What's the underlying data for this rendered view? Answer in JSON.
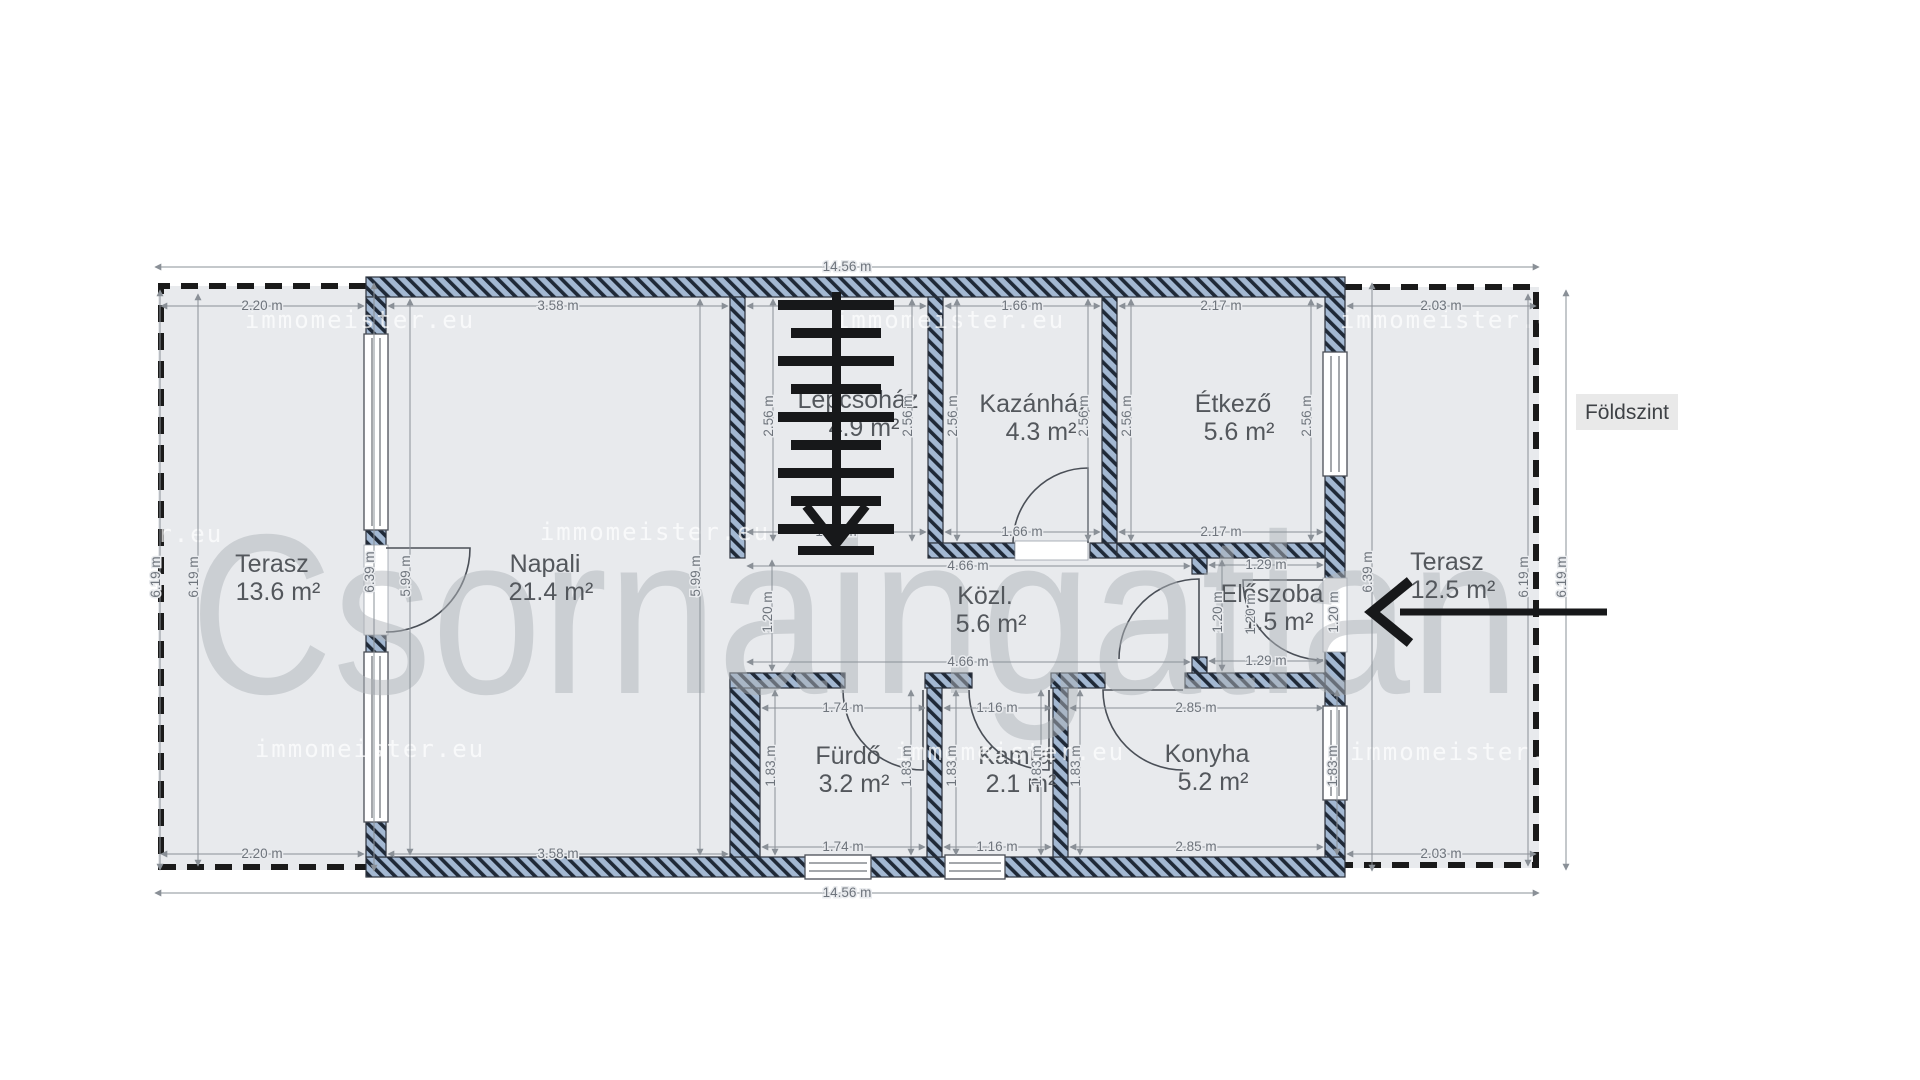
{
  "floor_label": "Földszint",
  "watermarks": {
    "brand": "Csornaingatlan",
    "site": "immomeister.eu",
    "site_positions": [
      [
        360,
        328
      ],
      [
        950,
        328
      ],
      [
        1455,
        328
      ],
      [
        108,
        542
      ],
      [
        655,
        540
      ],
      [
        370,
        757
      ],
      [
        1010,
        760
      ],
      [
        1465,
        760
      ]
    ]
  },
  "colors": {
    "wall_fill": "#a3b8d2",
    "wall_stripe": "#1f2937",
    "room_fill": "#e8eaed",
    "dim_text": "#6e747c",
    "room_text": "#53575c",
    "terrace_dash": "#1a1a1a"
  },
  "rooms": [
    {
      "name": "Terasz",
      "area": "13.6 m²",
      "x": 272,
      "y": 572
    },
    {
      "name": "Napali",
      "area": "21.4 m²",
      "x": 545,
      "y": 572
    },
    {
      "name": "Lépcsőház",
      "area": "4.9 m²",
      "x": 858,
      "y": 408
    },
    {
      "name": "Kazánház",
      "area": "4.3 m²",
      "x": 1035,
      "y": 412
    },
    {
      "name": "Étkező",
      "area": "5.6 m²",
      "x": 1233,
      "y": 412
    },
    {
      "name": "Közl.",
      "area": "5.6 m²",
      "x": 985,
      "y": 604
    },
    {
      "name": "Előszoba",
      "area": "1.5 m²",
      "x": 1272,
      "y": 602
    },
    {
      "name": "Fürdő",
      "area": "3.2 m²",
      "x": 848,
      "y": 764
    },
    {
      "name": "Kamra",
      "area": "2.1 m²",
      "x": 1015,
      "y": 764
    },
    {
      "name": "Konyha",
      "area": "5.2 m²",
      "x": 1207,
      "y": 762
    },
    {
      "name": "Terasz",
      "area": "12.5 m²",
      "x": 1447,
      "y": 570
    }
  ],
  "dimensions": [
    {
      "t": "14.56 m",
      "x": 847,
      "y": 271,
      "r": 0,
      "l": [
        155,
        267,
        1539,
        267
      ]
    },
    {
      "t": "2.20 m",
      "x": 262,
      "y": 310,
      "r": 0,
      "l": [
        161,
        306,
        364,
        306
      ]
    },
    {
      "t": "3.58 m",
      "x": 558,
      "y": 310,
      "r": 0,
      "l": [
        388,
        306,
        728,
        306
      ]
    },
    {
      "t": "1.91 m",
      "x": 836,
      "y": 310,
      "r": 0,
      "l": [
        747,
        306,
        926,
        306
      ]
    },
    {
      "t": "1.66 m",
      "x": 1022,
      "y": 310,
      "r": 0,
      "l": [
        945,
        306,
        1100,
        306
      ]
    },
    {
      "t": "2.17 m",
      "x": 1221,
      "y": 310,
      "r": 0,
      "l": [
        1119,
        306,
        1323,
        306
      ]
    },
    {
      "t": "2.03 m",
      "x": 1441,
      "y": 310,
      "r": 0,
      "l": [
        1347,
        306,
        1536,
        306
      ]
    },
    {
      "t": "1.91 m",
      "x": 836,
      "y": 536,
      "r": 0,
      "l": [
        747,
        532,
        926,
        532
      ]
    },
    {
      "t": "1.66 m",
      "x": 1022,
      "y": 536,
      "r": 0,
      "l": [
        945,
        532,
        1100,
        532
      ]
    },
    {
      "t": "2.17 m",
      "x": 1221,
      "y": 536,
      "r": 0,
      "l": [
        1119,
        532,
        1323,
        532
      ]
    },
    {
      "t": "4.66 m",
      "x": 968,
      "y": 570,
      "r": 0,
      "l": [
        747,
        566,
        1190,
        566
      ]
    },
    {
      "t": "4.66 m",
      "x": 968,
      "y": 666,
      "r": 0,
      "l": [
        747,
        662,
        1190,
        662
      ]
    },
    {
      "t": "1.29 m",
      "x": 1266,
      "y": 569,
      "r": 0,
      "l": [
        1209,
        565,
        1323,
        565
      ]
    },
    {
      "t": "1.29 m",
      "x": 1266,
      "y": 665,
      "r": 0,
      "l": [
        1209,
        661,
        1323,
        661
      ]
    },
    {
      "t": "1.74 m",
      "x": 843,
      "y": 712,
      "r": 0,
      "l": [
        762,
        708,
        925,
        708
      ]
    },
    {
      "t": "1.16 m",
      "x": 997,
      "y": 712,
      "r": 0,
      "l": [
        944,
        708,
        1051,
        708
      ]
    },
    {
      "t": "2.85 m",
      "x": 1196,
      "y": 712,
      "r": 0,
      "l": [
        1070,
        708,
        1323,
        708
      ]
    },
    {
      "t": "1.74 m",
      "x": 843,
      "y": 851,
      "r": 0,
      "l": [
        762,
        847,
        925,
        847
      ]
    },
    {
      "t": "1.16 m",
      "x": 997,
      "y": 851,
      "r": 0,
      "l": [
        944,
        847,
        1051,
        847
      ]
    },
    {
      "t": "2.85 m",
      "x": 1196,
      "y": 851,
      "r": 0,
      "l": [
        1070,
        847,
        1323,
        847
      ]
    },
    {
      "t": "2.20 m",
      "x": 262,
      "y": 858,
      "r": 0,
      "l": [
        161,
        854,
        364,
        854
      ]
    },
    {
      "t": "3.58 m",
      "x": 558,
      "y": 858,
      "r": 0,
      "l": [
        388,
        854,
        728,
        854
      ]
    },
    {
      "t": "2.03 m",
      "x": 1441,
      "y": 858,
      "r": 0,
      "l": [
        1347,
        854,
        1536,
        854
      ]
    },
    {
      "t": "14.56 m",
      "x": 847,
      "y": 897,
      "r": 0,
      "l": [
        155,
        893,
        1539,
        893
      ]
    },
    {
      "t": "6.19 m",
      "x": 160,
      "y": 577,
      "r": 1,
      "l": [
        160,
        290,
        160,
        870
      ]
    },
    {
      "t": "6.19 m",
      "x": 198,
      "y": 577,
      "r": 1,
      "l": [
        198,
        294,
        198,
        866
      ]
    },
    {
      "t": "6.19 m",
      "x": 1528,
      "y": 577,
      "r": 1,
      "l": [
        1528,
        294,
        1528,
        866
      ]
    },
    {
      "t": "6.19 m",
      "x": 1566,
      "y": 577,
      "r": 1,
      "l": [
        1566,
        290,
        1566,
        870
      ]
    },
    {
      "t": "6.39 m",
      "x": 374,
      "y": 572,
      "r": 1,
      "l": [
        374,
        283,
        374,
        871
      ]
    },
    {
      "t": "5.99 m",
      "x": 410,
      "y": 576,
      "r": 1,
      "l": [
        410,
        299,
        410,
        855
      ]
    },
    {
      "t": "5.99 m",
      "x": 700,
      "y": 576,
      "r": 1,
      "l": [
        700,
        299,
        700,
        855
      ]
    },
    {
      "t": "6.39 m",
      "x": 1372,
      "y": 572,
      "r": 1,
      "l": [
        1372,
        283,
        1372,
        871
      ]
    },
    {
      "t": "2.56 m",
      "x": 773,
      "y": 416,
      "r": 1,
      "l": [
        773,
        299,
        773,
        541
      ]
    },
    {
      "t": "2.56 m",
      "x": 912,
      "y": 416,
      "r": 1,
      "l": [
        912,
        299,
        912,
        541
      ]
    },
    {
      "t": "2.56 m",
      "x": 957,
      "y": 416,
      "r": 1,
      "l": [
        957,
        299,
        957,
        541
      ]
    },
    {
      "t": "2.56 m",
      "x": 1088,
      "y": 416,
      "r": 1,
      "l": [
        1088,
        299,
        1088,
        541
      ]
    },
    {
      "t": "2.56 m",
      "x": 1131,
      "y": 416,
      "r": 1,
      "l": [
        1131,
        299,
        1131,
        541
      ]
    },
    {
      "t": "2.56 m",
      "x": 1311,
      "y": 416,
      "r": 1,
      "l": [
        1311,
        299,
        1311,
        541
      ]
    },
    {
      "t": "1.20 m",
      "x": 772,
      "y": 612,
      "r": 1,
      "l": [
        772,
        560,
        772,
        671
      ]
    },
    {
      "t": "1.20 m",
      "x": 1222,
      "y": 612,
      "r": 1,
      "l": [
        1222,
        560,
        1222,
        671
      ]
    },
    {
      "t": "1.20 m",
      "x": 1255,
      "y": 614,
      "r": 1
    },
    {
      "t": "1.20 m",
      "x": 1338,
      "y": 612,
      "r": 1
    },
    {
      "t": "1.83 m",
      "x": 775,
      "y": 766,
      "r": 1,
      "l": [
        775,
        690,
        775,
        855
      ]
    },
    {
      "t": "1.83 m",
      "x": 911,
      "y": 766,
      "r": 1,
      "l": [
        911,
        690,
        911,
        855
      ]
    },
    {
      "t": "1.83 m",
      "x": 956,
      "y": 766,
      "r": 1,
      "l": [
        956,
        690,
        956,
        855
      ]
    },
    {
      "t": "1.83 m",
      "x": 1041,
      "y": 766,
      "r": 1,
      "l": [
        1041,
        690,
        1041,
        855
      ]
    },
    {
      "t": "1.83 m",
      "x": 1080,
      "y": 766,
      "r": 1,
      "l": [
        1080,
        690,
        1080,
        855
      ]
    },
    {
      "t": "1.83 m",
      "x": 1337,
      "y": 766,
      "r": 1,
      "l": [
        1337,
        690,
        1337,
        855
      ]
    }
  ]
}
